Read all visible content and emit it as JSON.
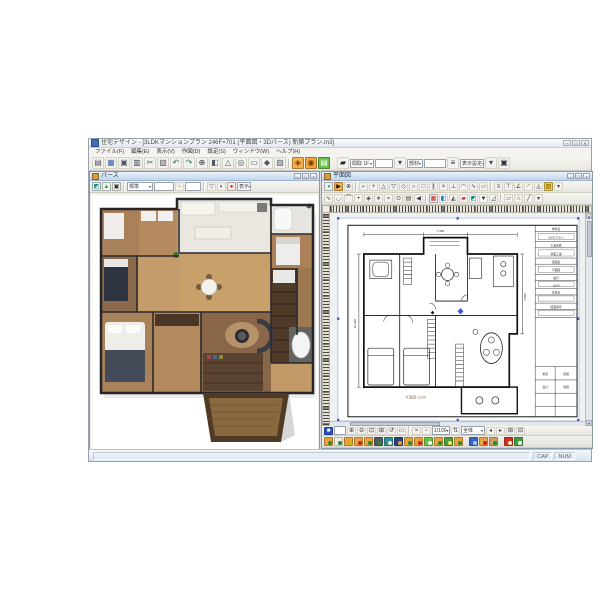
{
  "app": {
    "title": "住宅デザイン - [3LDKマンションプラン 246F×701 (平面図・3Dパース) 新築プラン.m3]",
    "menu": [
      "ファイル(F)",
      "編集(E)",
      "表示(V)",
      "作図(D)",
      "設定(S)",
      "ウィンドウ(W)",
      "ヘルプ(H)"
    ],
    "window_buttons": [
      "–",
      "□",
      "×"
    ],
    "accent_orange": "#f5b04d",
    "accent_green": "#6abf4b",
    "toolbar": [
      [
        "b",
        "▤",
        "#556"
      ],
      [
        "b",
        "▦",
        "#46a"
      ],
      [
        "b",
        "▣",
        "#556"
      ],
      [
        "b",
        "▥",
        "#445"
      ],
      [
        "b",
        "✂",
        "#556"
      ],
      [
        "b",
        "▧",
        "#556"
      ],
      [
        "b",
        "↶",
        "#2a7a3a"
      ],
      [
        "b",
        "↷",
        "#2a7a3a"
      ],
      [
        "b",
        "⊕",
        "#334"
      ],
      [
        "b",
        "◧",
        "#556"
      ],
      [
        "b",
        "△",
        "#556"
      ],
      [
        "b",
        "◎",
        "#556"
      ],
      [
        "b",
        "▭",
        "#556"
      ],
      [
        "b",
        "◆",
        "#556"
      ],
      [
        "b",
        "▨",
        "#556"
      ],
      [
        "s"
      ],
      [
        "b",
        "◈",
        "#7a3d00",
        "#f5b04d"
      ],
      [
        "b",
        "◉",
        "#7a3d00",
        "#efa43c"
      ],
      [
        "b",
        "▤",
        "#fff",
        "#6abf4b"
      ],
      [
        "g",
        5
      ],
      [
        "b",
        "▰",
        "#223"
      ],
      [
        "c",
        "間取 1F",
        null,
        24
      ],
      [
        "f",
        18
      ],
      [
        "b",
        "▾",
        "#445"
      ],
      [
        "c",
        "部材",
        null,
        16
      ],
      [
        "f",
        22
      ],
      [
        "b",
        "≡",
        "#334"
      ],
      [
        "c",
        "表示設定",
        null,
        24
      ],
      [
        "b",
        "▾",
        "#445"
      ],
      [
        "b",
        "▣",
        "#334"
      ]
    ]
  },
  "left_window": {
    "title": "パース",
    "window_buttons": [
      "–",
      "□",
      "×"
    ],
    "toolbar": [
      [
        "b",
        "◩",
        "#0a8a7a",
        "#e8f4f1"
      ],
      [
        "b",
        "▲",
        "#2f9e4f",
        "#eef6ee"
      ],
      [
        "b",
        "▣",
        "#333",
        "#f1f0ec"
      ],
      [
        "s"
      ],
      [
        "c",
        "標準",
        null,
        26
      ],
      [
        "f",
        20
      ],
      [
        "b",
        "▫",
        "#555"
      ],
      [
        "f",
        16
      ],
      [
        "s"
      ],
      [
        "b",
        "▽",
        "#555"
      ],
      [
        "b",
        "◐",
        "#444"
      ],
      [
        "b",
        "●",
        "#c22",
        "#f6eeee"
      ],
      [
        "c",
        "表示",
        null,
        14
      ]
    ]
  },
  "right_window": {
    "title": "平面図",
    "window_buttons": [
      "–",
      "□",
      "×"
    ],
    "toolbar1": [
      [
        "b",
        "◑",
        "#066",
        "#e8f2f0"
      ],
      [
        "b",
        "▶",
        "#111",
        "#f5b04d"
      ],
      [
        "b",
        "⊕",
        "#333"
      ],
      [
        "s"
      ],
      [
        "b",
        "⌐",
        "#333"
      ],
      [
        "b",
        "+",
        "#333"
      ],
      [
        "b",
        "△",
        "#333"
      ],
      [
        "b",
        "▽",
        "#333"
      ],
      [
        "b",
        "◇",
        "#333"
      ],
      [
        "b",
        "○",
        "#333"
      ],
      [
        "b",
        "□",
        "#333"
      ],
      [
        "b",
        "∥",
        "#333"
      ],
      [
        "b",
        "×",
        "#333"
      ],
      [
        "b",
        "⊥",
        "#333"
      ],
      [
        "b",
        "◠",
        "#333"
      ],
      [
        "b",
        "∿",
        "#333"
      ],
      [
        "b",
        "▱",
        "#333"
      ],
      [
        "s"
      ],
      [
        "b",
        "≡",
        "#333"
      ],
      [
        "b",
        "⊤",
        "#333"
      ],
      [
        "b",
        "∠",
        "#333"
      ],
      [
        "b",
        "◜",
        "#333"
      ],
      [
        "b",
        "◬",
        "#333"
      ],
      [
        "b",
        "▨",
        "#7a5a00",
        "#f0d24a"
      ],
      [
        "b",
        "▾",
        "#445"
      ]
    ],
    "toolbar2": [
      [
        "b",
        "∿",
        "#333"
      ],
      [
        "b",
        "◡",
        "#333"
      ],
      [
        "b",
        "⌒",
        "#333"
      ],
      [
        "b",
        "•",
        "#333"
      ],
      [
        "b",
        "◈",
        "#333"
      ],
      [
        "b",
        "∗",
        "#333"
      ],
      [
        "b",
        "≈",
        "#333"
      ],
      [
        "b",
        "⊙",
        "#333"
      ],
      [
        "b",
        "▤",
        "#333"
      ],
      [
        "b",
        "◀",
        "#333"
      ],
      [
        "s"
      ],
      [
        "b",
        "▦",
        "#b22",
        "#f4ecec"
      ],
      [
        "b",
        "◧",
        "#07a"
      ],
      [
        "b",
        "◭",
        "#333"
      ],
      [
        "b",
        "▰",
        "#b23"
      ],
      [
        "b",
        "◩",
        "#087"
      ],
      [
        "b",
        "▼",
        "#234"
      ],
      [
        "b",
        "◿",
        "#333"
      ],
      [
        "s"
      ],
      [
        "b",
        "▱",
        "#333"
      ],
      [
        "b",
        "∴",
        "#333"
      ],
      [
        "b",
        "╱",
        "#333"
      ],
      [
        "b",
        "▾",
        "#445"
      ]
    ],
    "bottom_toolbar": [
      [
        "b",
        "■",
        "#fff",
        "#2a52c8"
      ],
      [
        "f",
        12
      ],
      [
        "b",
        "⊕",
        "#333"
      ],
      [
        "b",
        "⊖",
        "#333"
      ],
      [
        "b",
        "⊡",
        "#333"
      ],
      [
        "b",
        "⊞",
        "#333"
      ],
      [
        "b",
        "↺",
        "#333"
      ],
      [
        "b",
        "▭",
        "#333"
      ],
      [
        "s"
      ],
      [
        "b",
        "≈",
        "#333"
      ],
      [
        "b",
        "▫",
        "#333"
      ],
      [
        "c",
        "1/100",
        null,
        18
      ],
      [
        "b",
        "⇅",
        "#445"
      ],
      [
        "c",
        "全体",
        null,
        24
      ],
      [
        "b",
        "◂",
        "#445"
      ],
      [
        "b",
        "▸",
        "#445"
      ],
      [
        "b",
        "⊞",
        "#334"
      ],
      [
        "b",
        "⊟",
        "#334"
      ]
    ],
    "layers": [
      [
        "#e8a33d",
        "#2a8a2a"
      ],
      [
        "#f0efe6",
        "#2a8a2a"
      ],
      [
        "#e8a33d",
        "#d4b400"
      ],
      [
        "#e8a33d",
        "#cc2222"
      ],
      [
        "#e8a33d",
        "#2a8a2a"
      ],
      [
        "#555b66",
        "#2a8a2a"
      ],
      [
        "#2f8f8f",
        "#e8f4f0"
      ],
      [
        "#29427a",
        "#e8a33d"
      ],
      [
        "#e8a33d",
        "#2a8a2a"
      ],
      [
        "#e8a33d",
        "#cc2222"
      ],
      [
        "#6abf4b",
        "#f4fff0"
      ],
      [
        "#e8a33d",
        "#2a8a2a"
      ],
      [
        "#4a9e3f",
        "#ffdd55"
      ],
      [
        "#e8a33d",
        "#2a8a2a"
      ],
      [
        "g",
        4
      ],
      [
        "#3a66c8",
        "#9cd4e8"
      ],
      [
        "#e8a33d",
        "#cc2222"
      ],
      [
        "#c9a063",
        "#2a8a2a"
      ],
      [
        "g",
        4
      ],
      [
        "#cc3322",
        "#ffe8cc"
      ],
      [
        "#3f9e3f",
        "#ffffff"
      ]
    ],
    "plan": {
      "label": "平面図 1/100",
      "marker_color": "#3555d8",
      "dims": [
        "7,280",
        "10,920",
        "4,550"
      ],
      "tb": [
        "物件名",
        "3LDKプラン",
        "工事名称",
        "新築工事",
        "図面名",
        "平面図",
        "縮尺",
        "1/100",
        "作成日",
        "図面番号",
        "承認",
        "検図",
        "設計",
        "製図"
      ]
    }
  },
  "status_bar": {
    "items": [
      "CAP",
      "NUM"
    ]
  }
}
